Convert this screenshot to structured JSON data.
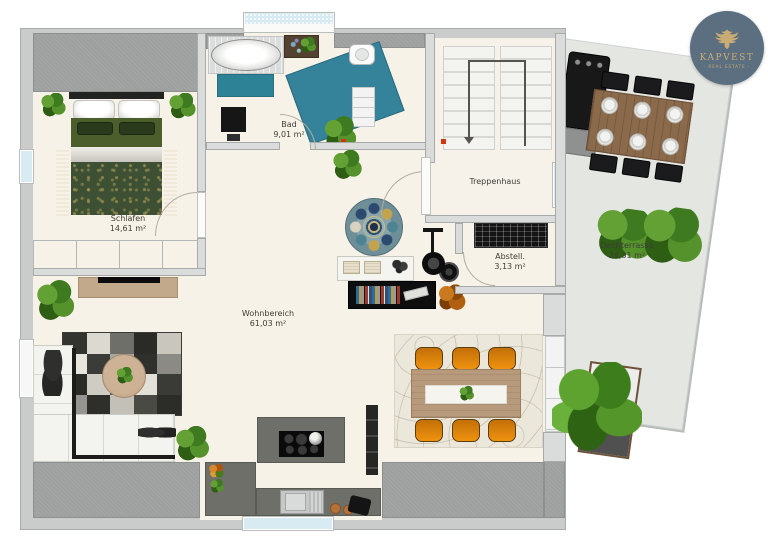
{
  "branding": {
    "name": "KAPVEST",
    "tagline": "- REAL ESTATE -",
    "badge_color": "#5b6f80",
    "accent_gold": "#c9ab74"
  },
  "rooms": {
    "schlafen": {
      "label": "Schlafen",
      "area": "14,61 m²"
    },
    "bad": {
      "label": "Bad",
      "area": "9,01 m²"
    },
    "treppenhaus": {
      "label": "Treppenhaus"
    },
    "abstell": {
      "label": "Abstell.",
      "area": "3,13 m²"
    },
    "wohnbereich": {
      "label": "Wohnbereich",
      "area": "61,03 m²"
    },
    "dachterrasse": {
      "label": "Dachterrasse",
      "area": "24,31 m²"
    }
  },
  "palette": {
    "floor": "#f7f2e7",
    "roof_eave": "#c9cccb",
    "roof_dark": "#9da09e",
    "terrace_deck": "#e4e6e2",
    "water_teal": "#35839a",
    "chair_orange": "#ef920f",
    "bed_green": "#3d5033",
    "window_glass": "#d9ebf2"
  }
}
